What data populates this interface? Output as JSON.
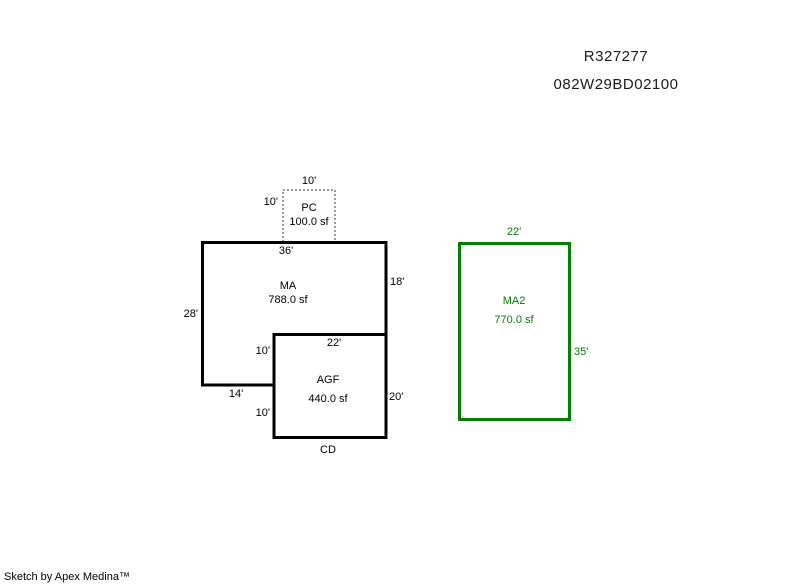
{
  "header": {
    "record_id": "R327277",
    "parcel_id": "082W29BD02100"
  },
  "sketch": {
    "pc": {
      "code": "PC",
      "area": "100.0 sf",
      "dim_top": "10'",
      "dim_left": "10'"
    },
    "ma": {
      "code": "MA",
      "area": "788.0 sf",
      "dim_top": "36'",
      "dim_right": "18'",
      "dim_left": "28'",
      "dim_bottom": "14'"
    },
    "agf": {
      "code": "AGF",
      "area": "440.0 sf",
      "dim_top": "22'",
      "dim_right": "20'",
      "dim_left_upper": "10'",
      "dim_left_lower": "10'",
      "label_bottom": "CD"
    },
    "ma2": {
      "code": "MA2",
      "area": "770.0 sf",
      "dim_top": "22'",
      "dim_right": "35'"
    }
  },
  "colors": {
    "outline": "#000000",
    "pc_outline": "#999999",
    "ma2_accent": "#008000"
  },
  "footer": {
    "credit": "Sketch by Apex Medina™"
  }
}
